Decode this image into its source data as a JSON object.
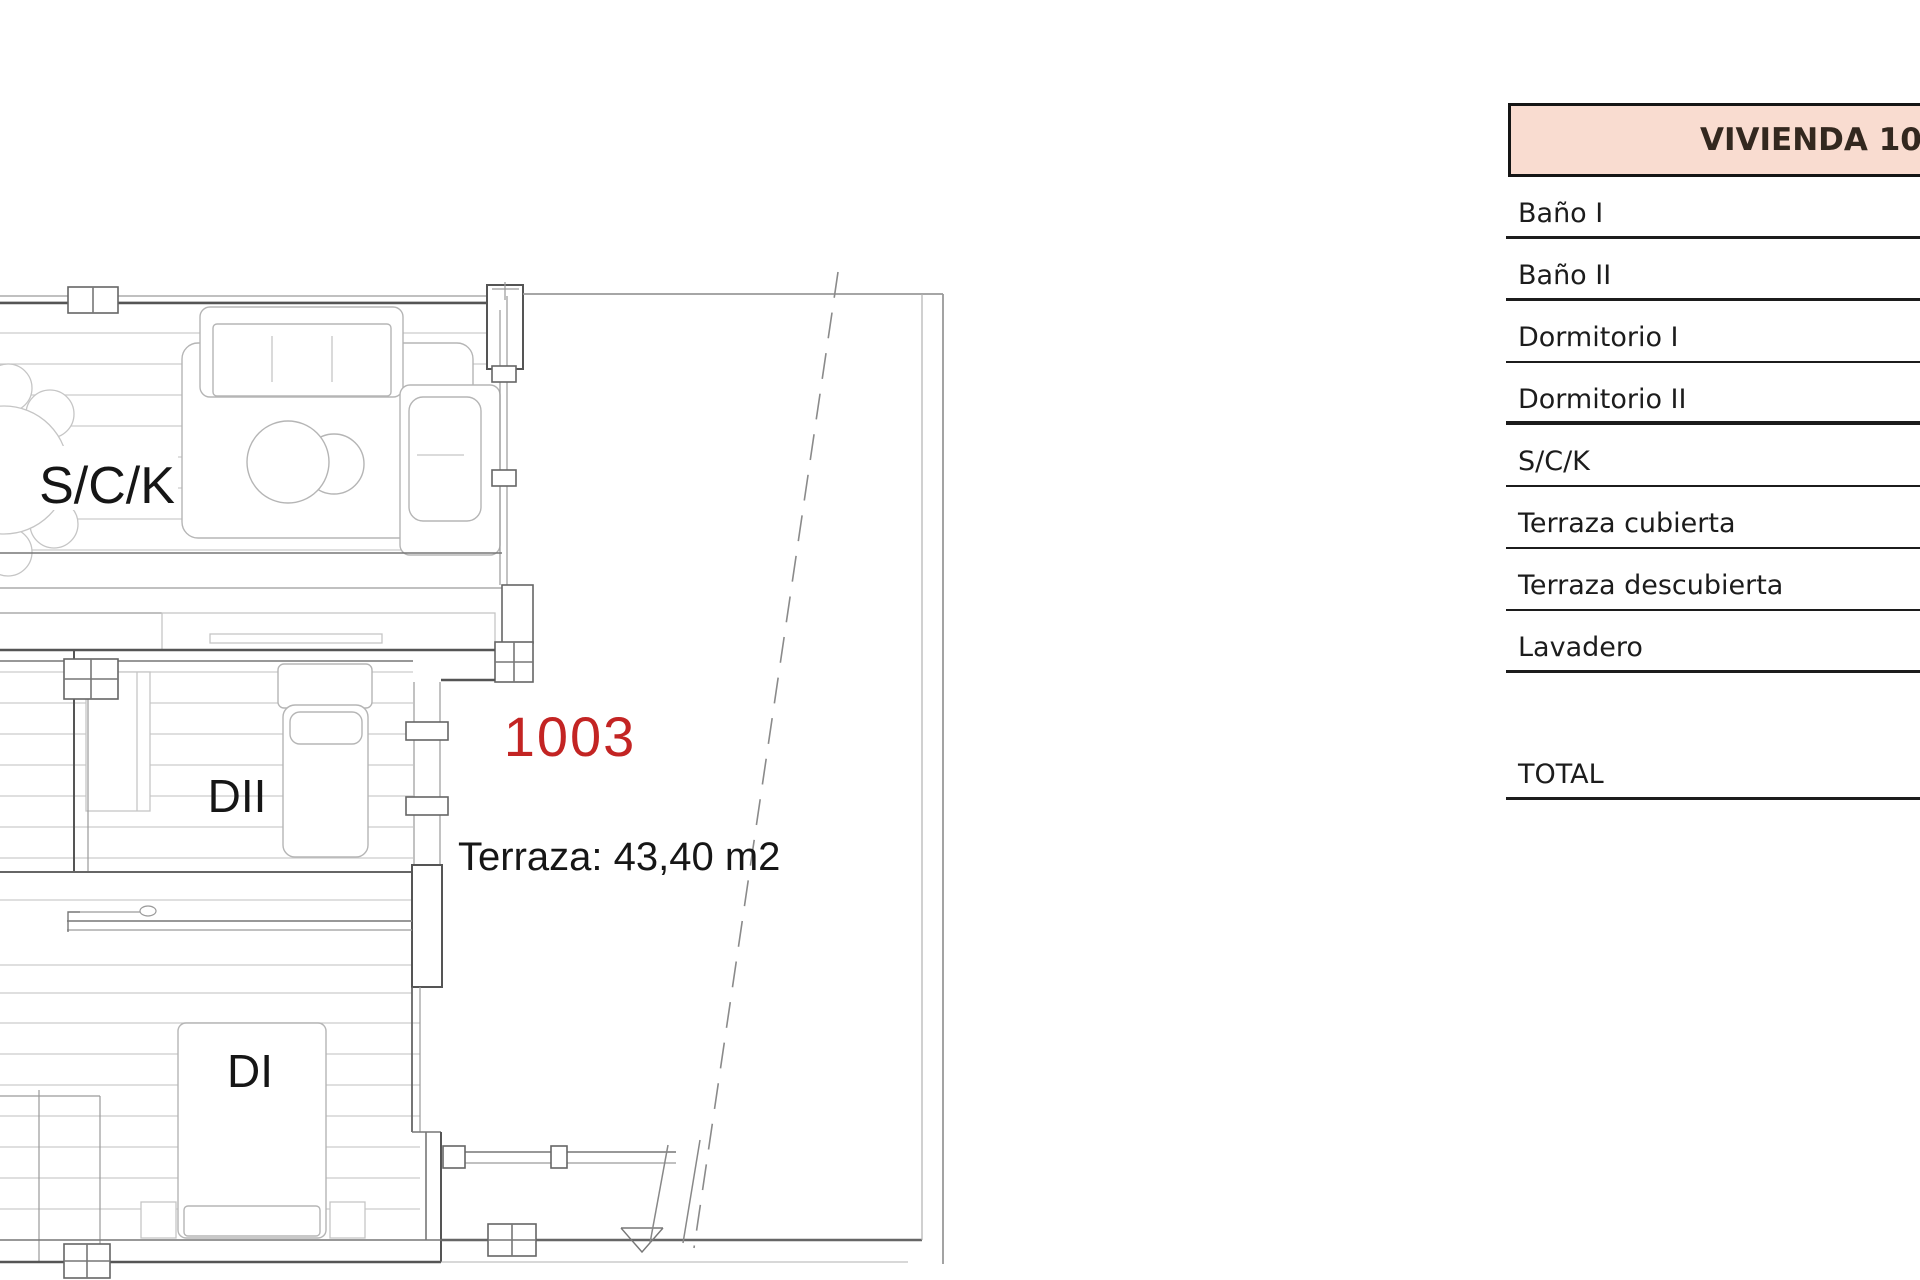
{
  "plan": {
    "unit_number": "1003",
    "unit_number_color": "#c32423",
    "terrace_label": "Terraza: 43,40 m2",
    "room_labels": {
      "living": "S/C/K",
      "bedroom2": "DII",
      "bedroom1": "DI"
    }
  },
  "table": {
    "title": "VIVIENDA 10",
    "title_fill": "#f9dcd0",
    "rows": [
      {
        "label": "Baño I"
      },
      {
        "label": "Baño II"
      },
      {
        "label": "Dormitorio I"
      },
      {
        "label": "Dormitorio II"
      },
      {
        "label": "S/C/K"
      },
      {
        "label": "Terraza cubierta"
      },
      {
        "label": "Terraza descubierta"
      },
      {
        "label": "Lavadero"
      }
    ],
    "total_label": "TOTAL"
  }
}
